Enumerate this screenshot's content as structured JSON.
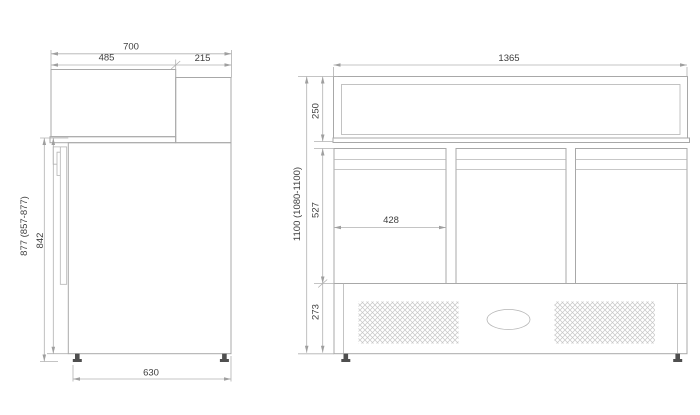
{
  "drawing": {
    "type": "technical-dimension-drawing",
    "views": {
      "side": {
        "label": "side-view",
        "dims": {
          "total_depth": "700",
          "canopy_depth": "485",
          "front_top_depth": "215",
          "overall_height": "877 (857-877)",
          "body_height": "842",
          "foot_span_depth": "630"
        }
      },
      "front": {
        "label": "front-view",
        "dims": {
          "total_width": "1365",
          "canopy_height": "250",
          "overall_height": "1100 (1080-1100)",
          "door_height": "527",
          "door_width": "428",
          "plinth_height": "273"
        }
      }
    },
    "colors": {
      "background": "#ffffff",
      "outline": "#a8a8a8",
      "dimension_lines": "#b0b0b0",
      "text": "#3e3e3e",
      "feet": "#4f4f4f",
      "vent_hatch": "#c6c6c6"
    }
  }
}
